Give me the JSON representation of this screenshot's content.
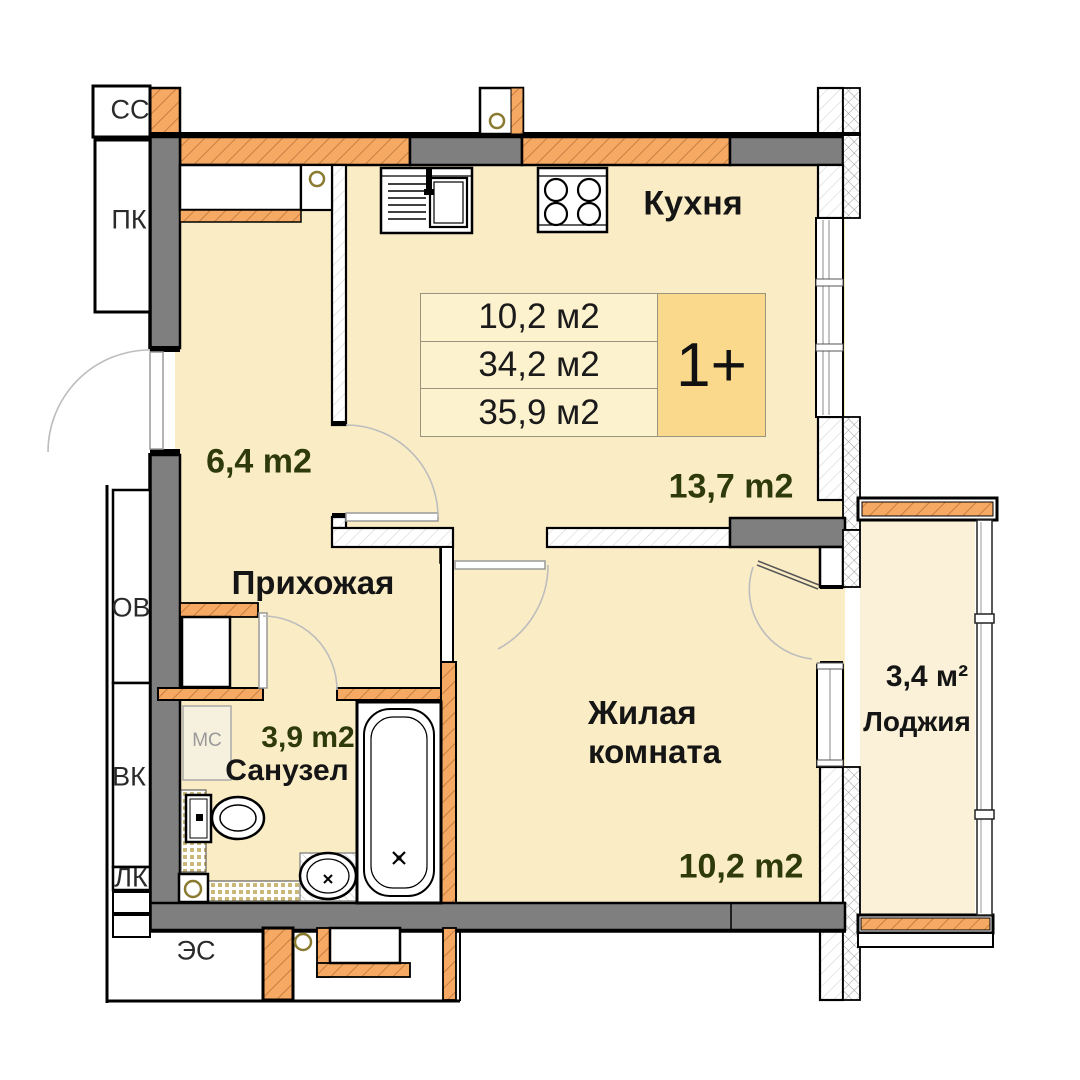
{
  "info_box": {
    "rows": [
      "10,2 м2",
      "34,2 м2",
      "35,9 м2"
    ],
    "type_label": "1+"
  },
  "rooms": {
    "kitchen": {
      "name": "Кухня",
      "area": "13,7 m2"
    },
    "hallway": {
      "name": "Прихожая",
      "area": "6,4 m2"
    },
    "bathroom": {
      "name": "Санузел",
      "area": "3,9 m2"
    },
    "living_room": {
      "name": "Жилая комната",
      "area": "10,2 m2"
    },
    "loggia": {
      "name": "Лоджия",
      "area": "3,4 м²"
    }
  },
  "utility_shafts": {
    "ss": "СС",
    "pk": "ПК",
    "ov": "ОВ",
    "vk": "ВК",
    "lk": "ЛК",
    "es": "ЭС"
  },
  "fixtures": {
    "washing_machine_label": "МС"
  },
  "colors": {
    "floor": "#FAECC5",
    "loggia_floor": "#FBF1D8",
    "wall_orange": "#F5A963",
    "wall_gray": "#7F7F7F",
    "info_row_bg": "#FCF2CE",
    "type_badge_bg": "#FBD98C",
    "area_text": "#2E3A0C",
    "label_text": "#151515"
  }
}
